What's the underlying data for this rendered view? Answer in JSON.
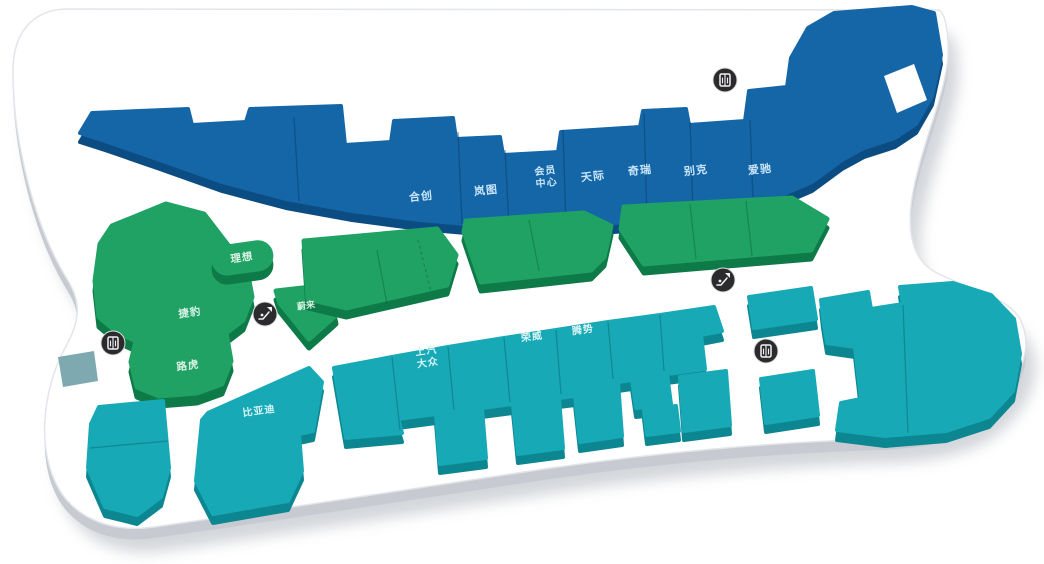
{
  "page": {
    "type": "auto-mall-3d-floor-map",
    "background_color": "#ffffff"
  },
  "colors": {
    "plate_top": "#ffffff",
    "plate_side": "#c7cbd1",
    "plate_shadow": "#a7adb6",
    "north_top": "#1566a7",
    "north_side": "#0b4c83",
    "north_label": "#c9e6fb",
    "west_top": "#1fa263",
    "west_side": "#0d7a48",
    "west_label": "#daf3e6",
    "south_top": "#17a9b5",
    "south_side": "#0c8791",
    "south_label": "#dbf5f7",
    "wedge": "#7fa9b1",
    "icon_bg": "#2b2b2d",
    "icon_fg": "#f2f2f2"
  },
  "zones": {
    "north": {
      "stores": [
        {
          "name": "合创"
        },
        {
          "name": "岚图"
        },
        {
          "name": "会员中心",
          "line1": "会员",
          "line2": "中心"
        },
        {
          "name": "天际"
        },
        {
          "name": "奇瑞"
        },
        {
          "name": "别克"
        },
        {
          "name": "爱驰"
        }
      ]
    },
    "west": {
      "stores": [
        {
          "name": "理想"
        },
        {
          "name": "蔚来"
        },
        {
          "name": "捷豹"
        },
        {
          "name": "路虎"
        }
      ]
    },
    "south": {
      "stores": [
        {
          "name": "比亚迪"
        },
        {
          "name": "上汽大众",
          "line1": "上汽",
          "line2": "大众"
        },
        {
          "name": "荣威"
        },
        {
          "name": "腾势"
        }
      ]
    }
  },
  "facilities": {
    "icons": [
      {
        "type": "elevator-icon",
        "location": "north-hall"
      },
      {
        "type": "elevator-icon",
        "location": "west-edge"
      },
      {
        "type": "elevator-icon",
        "location": "south-east"
      },
      {
        "type": "escalator-icon",
        "location": "west-hall"
      },
      {
        "type": "escalator-icon",
        "location": "center"
      }
    ]
  }
}
